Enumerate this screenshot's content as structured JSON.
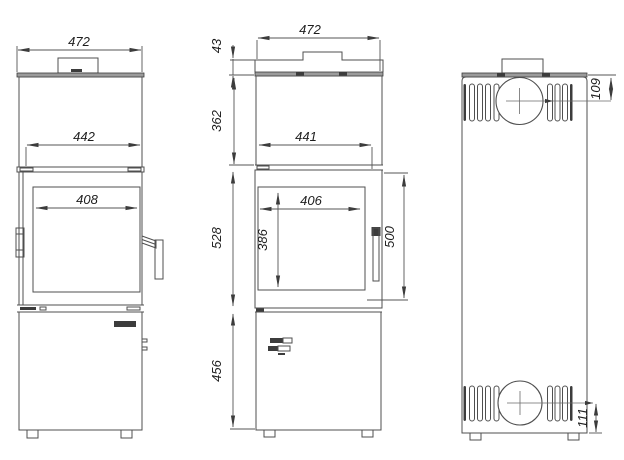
{
  "drawing": {
    "background_color": "#ffffff",
    "line_color": "#4f4f4f",
    "plate_color": "#9b9b9b",
    "dims": {
      "side_width": "472",
      "side_body_width": "442",
      "side_glass_width": "408",
      "front_width": "472",
      "front_cap_height": "43",
      "front_upper_height": "362",
      "front_body_width": "441",
      "front_glass_width": "406",
      "front_glass_height": "386",
      "front_glass_outer_height": "500",
      "front_door_height": "528",
      "front_base_height": "456",
      "back_flue_top_offset": "109",
      "back_flue_bottom_offset": "111"
    }
  }
}
